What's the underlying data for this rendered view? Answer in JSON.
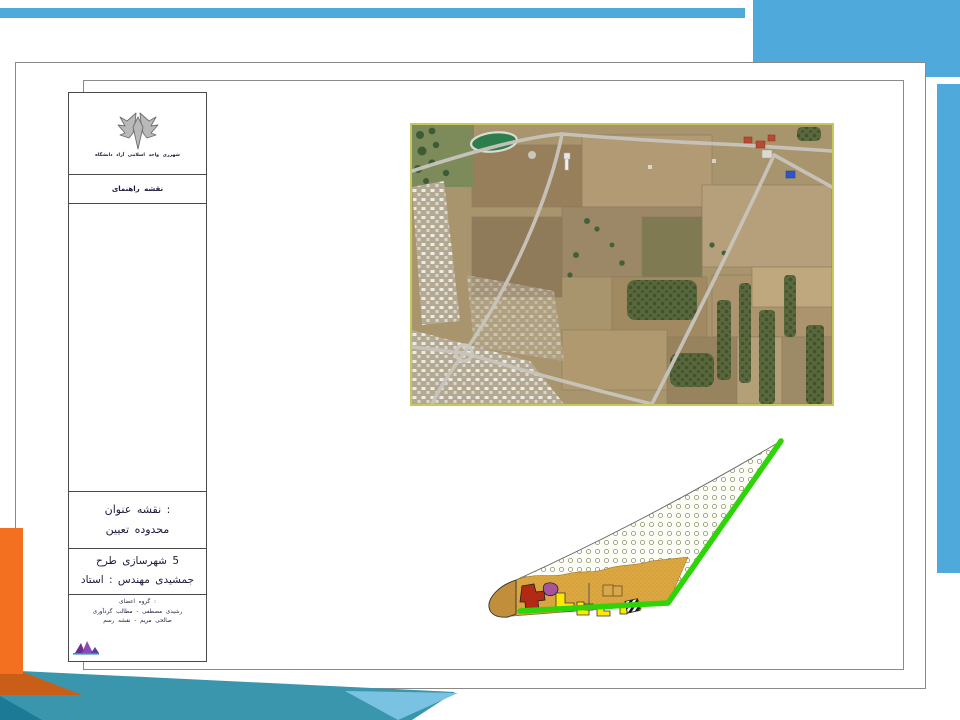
{
  "slide": {
    "kind": "presentation-slide-map-sheet",
    "title_block": {
      "university_caption_words": [
        "دانشگاه",
        "آزاد",
        "اسلامی",
        "واحد",
        "شهرری"
      ],
      "legend_words": [
        "راهنمای",
        "نقشه"
      ],
      "map_title": {
        "label_words": [
          "عنوان",
          "نقشه",
          ":"
        ],
        "value_words": [
          "تعیین",
          "محدوده"
        ]
      },
      "course": {
        "line1_words": [
          "طرح",
          "شهرسازی",
          "5"
        ],
        "line2_words": [
          "استاد",
          ":",
          "مهندس",
          "جمشیدی"
        ]
      },
      "credits": {
        "line1_words": [
          "اعضای",
          "گروه",
          ":"
        ],
        "line2_words": [
          "گردآوری",
          "مطالب",
          "-",
          "مصطفی",
          "رشیدی"
        ],
        "line3_words": [
          "رسم",
          "نقشه",
          "-",
          "مریم",
          "صالحی"
        ]
      }
    },
    "figures": {
      "satellite_map_name": "satellite-imagery-of-site",
      "landuse_plan_name": "site-boundary-landuse-plan"
    },
    "colors": {
      "accent_blue": "#4FA9DA",
      "accent_orange": "#F37021",
      "accent_orange_dark": "#C95E18",
      "accent_teal": "#3996AD",
      "accent_teal_dark": "#1D7A96",
      "accent_teal_light": "#7AC2E2",
      "plan_border_green": "#2FD408",
      "plan_tan": "#DCA741",
      "plan_brown_cap": "#C18F3C",
      "plan_red": "#B22A14",
      "plan_purple": "#A8549A",
      "plan_yellow": "#FFE800",
      "satellite_frame_yellow": "#C8C85A"
    }
  }
}
